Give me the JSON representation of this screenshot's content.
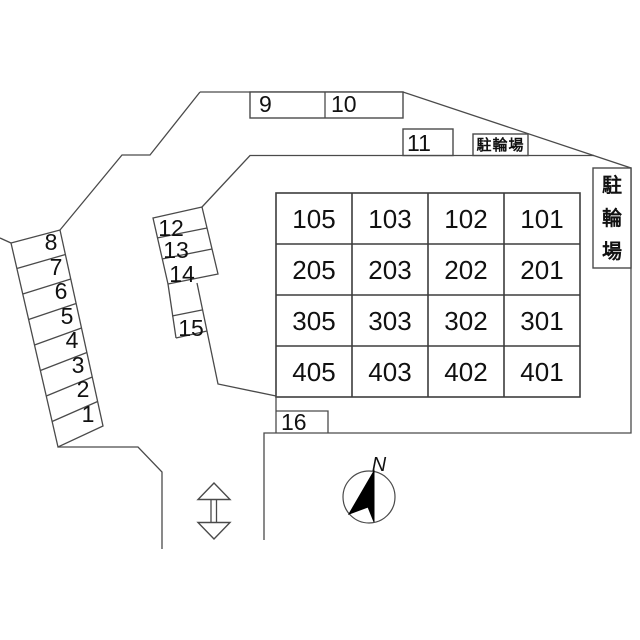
{
  "plan": {
    "top_row": {
      "spaces": [
        "9",
        "10",
        "11"
      ],
      "bicycle_parking": "駐輪場"
    },
    "right_side": {
      "bicycle_parking_chars": [
        "駐",
        "輪",
        "場"
      ]
    },
    "building_grid": {
      "rows": [
        [
          "105",
          "103",
          "102",
          "101"
        ],
        [
          "205",
          "203",
          "202",
          "201"
        ],
        [
          "305",
          "303",
          "302",
          "301"
        ],
        [
          "405",
          "403",
          "402",
          "401"
        ]
      ]
    },
    "left_stack": [
      "8",
      "7",
      "6",
      "5",
      "4",
      "3",
      "2",
      "1"
    ],
    "middle_stack": [
      "12",
      "13",
      "14"
    ],
    "space_15": "15",
    "space_16": "16",
    "compass_north": "N"
  },
  "colors": {
    "background": "#ffffff",
    "line": "#4a4a4a",
    "text": "#111111",
    "needle": "#000000"
  }
}
